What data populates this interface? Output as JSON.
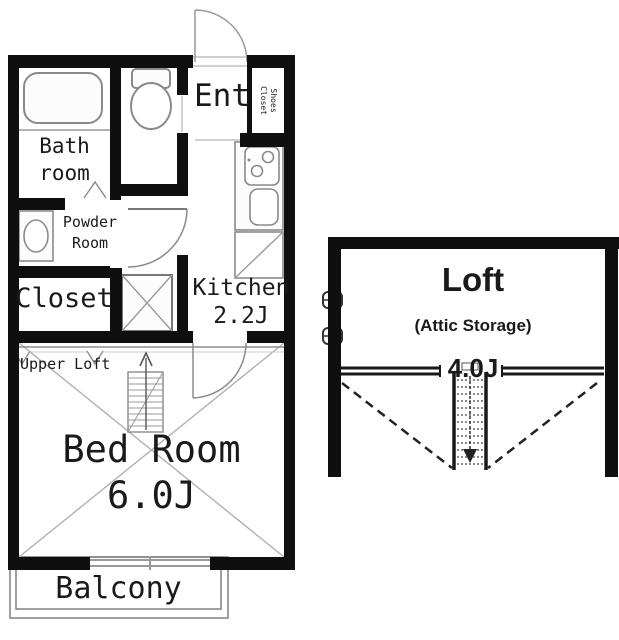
{
  "title": "Apartment floor plan",
  "colors": {
    "wall": "#0f0f0f",
    "fixture_line": "#8a8a8a",
    "thin_line": "#aaaaaa",
    "loft_line": "#1a1a1a",
    "text": "#1a1a1a",
    "background": "#ffffff"
  },
  "unit": {
    "bathroom": {
      "label_line1": "Bath",
      "label_line2": "room"
    },
    "entrance": {
      "label": "Ent"
    },
    "shoes_closet": {
      "label_line1": "Shoes",
      "label_line2": "Closet"
    },
    "powder_room": {
      "label_line1": "Powder",
      "label_line2": "Room"
    },
    "closet": {
      "label": "Closet"
    },
    "kitchen": {
      "label": "Kitchen",
      "size": "2.2J"
    },
    "upper_loft": {
      "label": "Upper Loft"
    },
    "bedroom": {
      "label": "Bed Room",
      "size": "6.0J"
    },
    "balcony": {
      "label": "Balcony"
    }
  },
  "loft": {
    "label": "Loft",
    "sublabel": "(Attic Storage)",
    "size": "4.0J"
  },
  "icons": {
    "bathtub": "rounded rectangle tub",
    "toilet": "tank and bowl",
    "washbasin": "oval basin in box",
    "stove": "two burner cooktop",
    "kitchen_sink": "rounded sink",
    "refrigerator_space": "square with diagonal",
    "washer_space": "square with X",
    "staircase": "rung box with up arrow",
    "ladder": "dotted ladder with down arrow",
    "door_swing": "quarter circle arc"
  }
}
